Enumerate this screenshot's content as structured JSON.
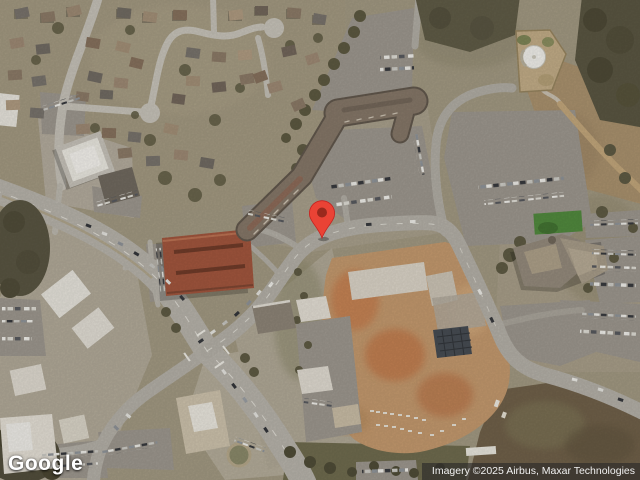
{
  "map": {
    "view_type": "satellite",
    "marker": {
      "name": "dropped-pin",
      "x": 322,
      "y": 238,
      "color": "#EA4335",
      "edge_color": "#C5221F",
      "dot_color": "#9A291D"
    }
  },
  "branding": {
    "logo_text": "Google"
  },
  "attribution": {
    "text": "Imagery ©2025 Airbus, Maxar Technologies"
  }
}
